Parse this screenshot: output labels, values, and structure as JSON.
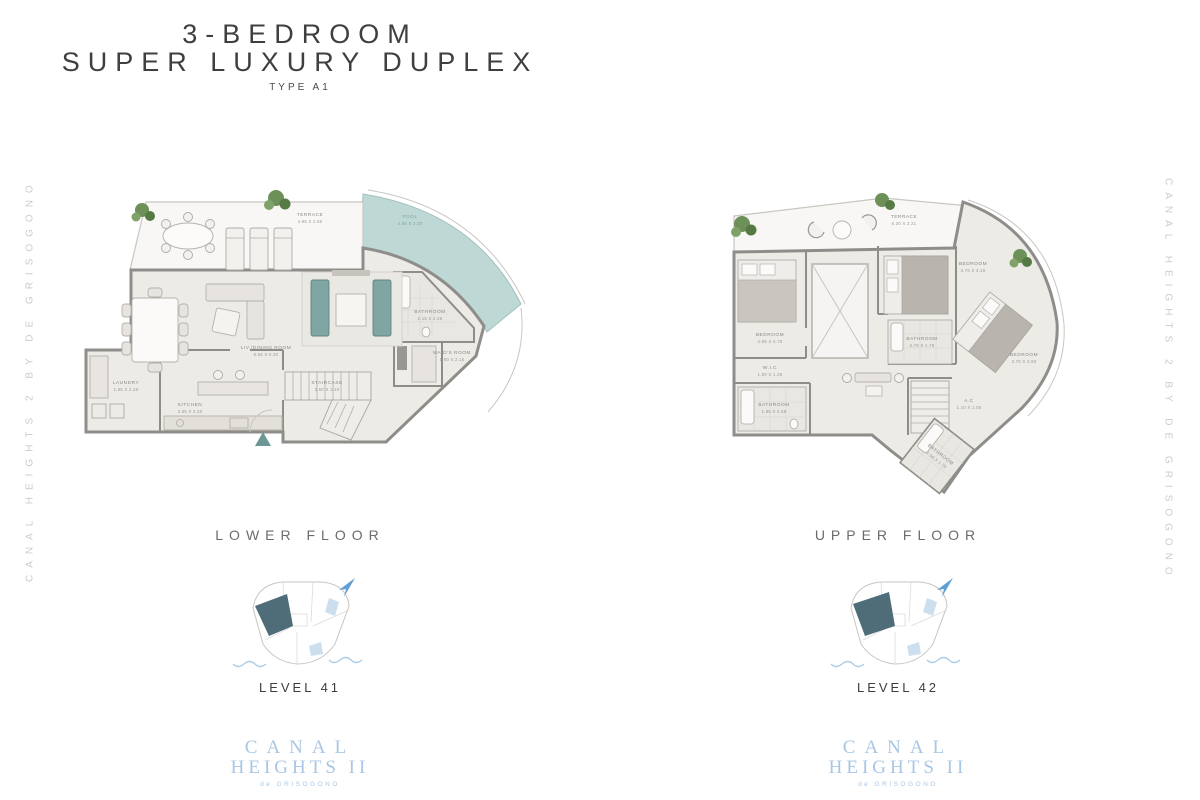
{
  "page": {
    "title_line1": "3-BEDROOM",
    "title_line2": "SUPER LUXURY DUPLEX",
    "type_label": "TYPE A1",
    "side_text_left": "CANAL HEIGHTS 2 BY DE GRISOGONO",
    "side_text_right": "CANAL HEIGHTS 2 BY DE GRISOGONO",
    "brand": {
      "line1": "CANAL",
      "line2": "HEIGHTS II",
      "line3": "de GRISOGONO"
    },
    "colors": {
      "brand_blue": "#a9c7e4",
      "pool_teal": "#bdd8d5",
      "sofa_teal": "#7fa6a2",
      "entry_teal": "#6d9795",
      "keyplan_highlight": "#4f6d78",
      "plant_green": "#6d9058"
    }
  },
  "lower_floor": {
    "caption": "LOWER FLOOR",
    "level_label": "LEVEL 41",
    "rooms": {
      "terrace": {
        "name": "TERRACE",
        "dims": "4.95 X 2.60"
      },
      "pool": {
        "name": "POOL",
        "dims": "4.55 X 2.20"
      },
      "living": {
        "name": "LIV./DINING ROOM",
        "dims": "5.56 X 5.30"
      },
      "kitchen": {
        "name": "KITCHEN",
        "dims": "3.65 X 2.20"
      },
      "laundry": {
        "name": "LAUNDRY",
        "dims": "1.95 X 2.20"
      },
      "bathroom": {
        "name": "BATHROOM",
        "dims": "2.15 X 2.26"
      },
      "maids_room": {
        "name": "MAID'S ROOM",
        "dims": "1.60 X 2.15"
      },
      "staircase": {
        "name": "STAIRCASE",
        "dims": "3.50 X 1.20"
      }
    }
  },
  "upper_floor": {
    "caption": "UPPER FLOOR",
    "level_label": "LEVEL 42",
    "rooms": {
      "terrace": {
        "name": "TERRACE",
        "dims": "6.30 X 2.21"
      },
      "bedroom_1": {
        "name": "BEDROOM",
        "dims": "2.95 X 4.78"
      },
      "bedroom_2": {
        "name": "BEDROOM",
        "dims": "3.76 X 3.19"
      },
      "bedroom_3": {
        "name": "BEDROOM",
        "dims": "3.70 X 3.80"
      },
      "bathroom_1": {
        "name": "BATHROOM",
        "dims": "1.95 X 2.58"
      },
      "bathroom_2": {
        "name": "BATHROOM",
        "dims": "2.76 X 1.78"
      },
      "bathroom_3": {
        "name": "BATHROOM",
        "dims": "2.96 X 1.79"
      },
      "wic": {
        "name": "W.I.C",
        "dims": "1.50 X 1.25"
      },
      "ac": {
        "name": "A.C",
        "dims": "1.10 X 1.05"
      }
    }
  }
}
